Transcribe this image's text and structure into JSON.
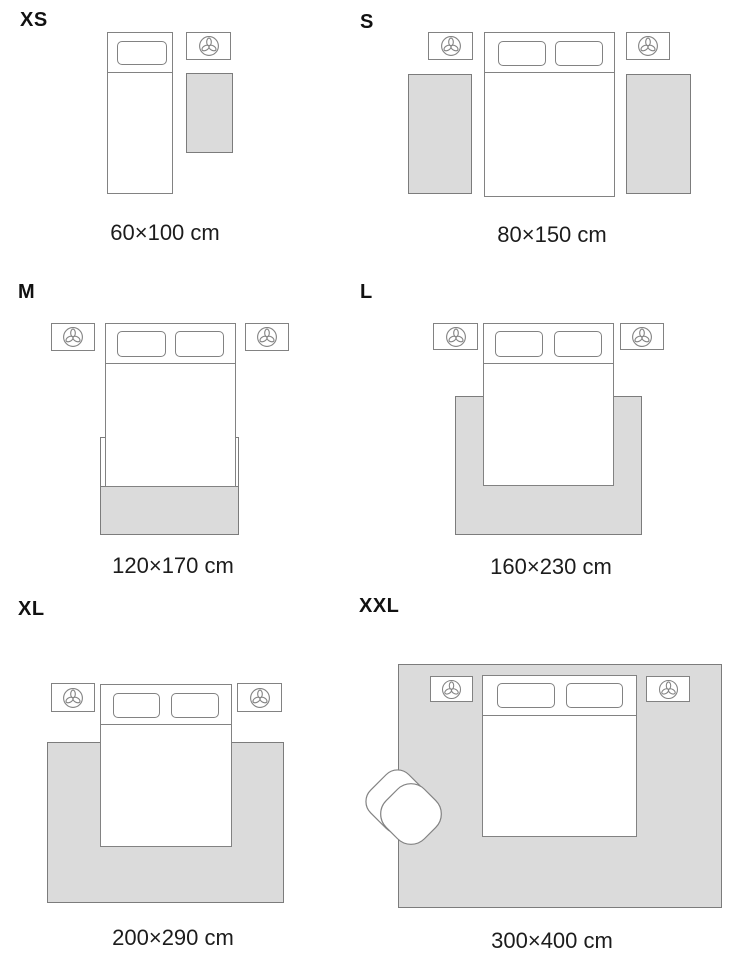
{
  "title": "Rug size guide",
  "colors": {
    "background": "#ffffff",
    "rug_fill": "#dbdbdb",
    "rug_border": "#7c7c7c",
    "furniture_border": "#828282",
    "text": "#1c1c1c"
  },
  "icons": {
    "nightstand_decor": "plant-icon",
    "seat": "armchair-icon"
  },
  "sizes": [
    {
      "id": "xs",
      "label": "XS",
      "dimensions": "60×100 cm"
    },
    {
      "id": "s",
      "label": "S",
      "dimensions": "80×150 cm"
    },
    {
      "id": "m",
      "label": "M",
      "dimensions": "120×170 cm"
    },
    {
      "id": "l",
      "label": "L",
      "dimensions": "160×230 cm"
    },
    {
      "id": "xl",
      "label": "XL",
      "dimensions": "200×290 cm"
    },
    {
      "id": "xxl",
      "label": "XXL",
      "dimensions": "300×400 cm"
    }
  ]
}
